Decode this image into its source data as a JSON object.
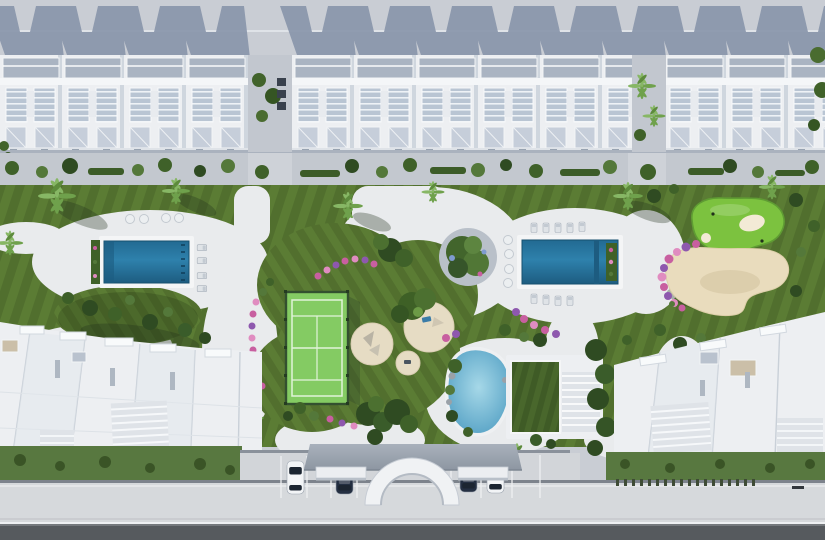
{
  "scene": {
    "type": "aerial-3d-architectural-render",
    "description": "Top-down masterplan rendering of a white residential resort community: a row of townhouses along the top, a central landscaped amenity garden with two rectangular pools, a padel court, circular play pads, a putting green with sand bunker, a lagoon pool and a green-roof clubhouse, two white apartment buildings at the bottom, and a street with gated parking entrance arch and four parked cars",
    "amenities": [
      {
        "id": "left-pool",
        "label": "rectangular swimming pool (west)"
      },
      {
        "id": "right-pool",
        "label": "rectangular swimming pool (east)"
      },
      {
        "id": "padel-court",
        "label": "fenced green padel / tennis court"
      },
      {
        "id": "play-pads",
        "label": "circular sand playground pads with shade sails"
      },
      {
        "id": "putting-green",
        "label": "golf putting green with white bunkers"
      },
      {
        "id": "sand-bunker",
        "label": "large sand garden bordered by flowers"
      },
      {
        "id": "lagoon-pool",
        "label": "organic lagoon pool with rocks"
      },
      {
        "id": "clubhouse",
        "label": "clubhouse with green roof and pergola"
      },
      {
        "id": "entrance-arch",
        "label": "arched street entrance gate"
      },
      {
        "id": "central-tree-bed",
        "label": "circular planting bed with trees"
      }
    ],
    "vehicles": {
      "count": 4,
      "body_colors": [
        "white",
        "dark-navy",
        "dark-navy",
        "white"
      ]
    },
    "counts": {
      "pools": 2,
      "courts": 1,
      "play_pads": 3,
      "sun_loungers": 13,
      "round_daybeds": 8,
      "townhouse_modules": 12,
      "bottom_buildings": 2
    }
  },
  "colors": {
    "ground": "#c9cdd4",
    "shadow": "#8693a9",
    "buildingWhite": "#edeff2",
    "roofSlab": "#aab4c2",
    "glass": "#b9c5d3",
    "promenade": "#c3c8cf",
    "lawnA": "#5b7c34",
    "lawnB": "#516f2e",
    "plaza": "#e9ebed",
    "poolEdge": "#1d5c80",
    "poolMid": "#2e81ac",
    "poolDeep": "#226a92",
    "court": "#84cb63",
    "courtLine": "#e2f3da",
    "fence": "#33502f",
    "sandPad": "#e6dcc4",
    "golfGreen": "#7cc23f",
    "bunker": "#f3ead6",
    "sand": "#e9dcbd",
    "lagoonCenter": "#a6d8e8",
    "lagoonEdge": "#4f9dc2",
    "roofGreenA": "#49672c",
    "roofGreenB": "#3f5b26",
    "pergola": "#dfe3e8",
    "treeDark": "#2f4b22",
    "treeMid": "#3f6129",
    "treeLight": "#54783a",
    "palm": "#6fa14c",
    "flowerPink": "#c85fa0",
    "flowerViolet": "#8e58ae",
    "flowerLight": "#e08cc0",
    "road": "#565a5e",
    "sidewalk": "#d6d9dc",
    "parking": "#d2d5d9",
    "canopy": "#98a1ac",
    "carDark": "#242f42",
    "carWhite": "#f2f4f6",
    "greenStrip": "#587840"
  }
}
